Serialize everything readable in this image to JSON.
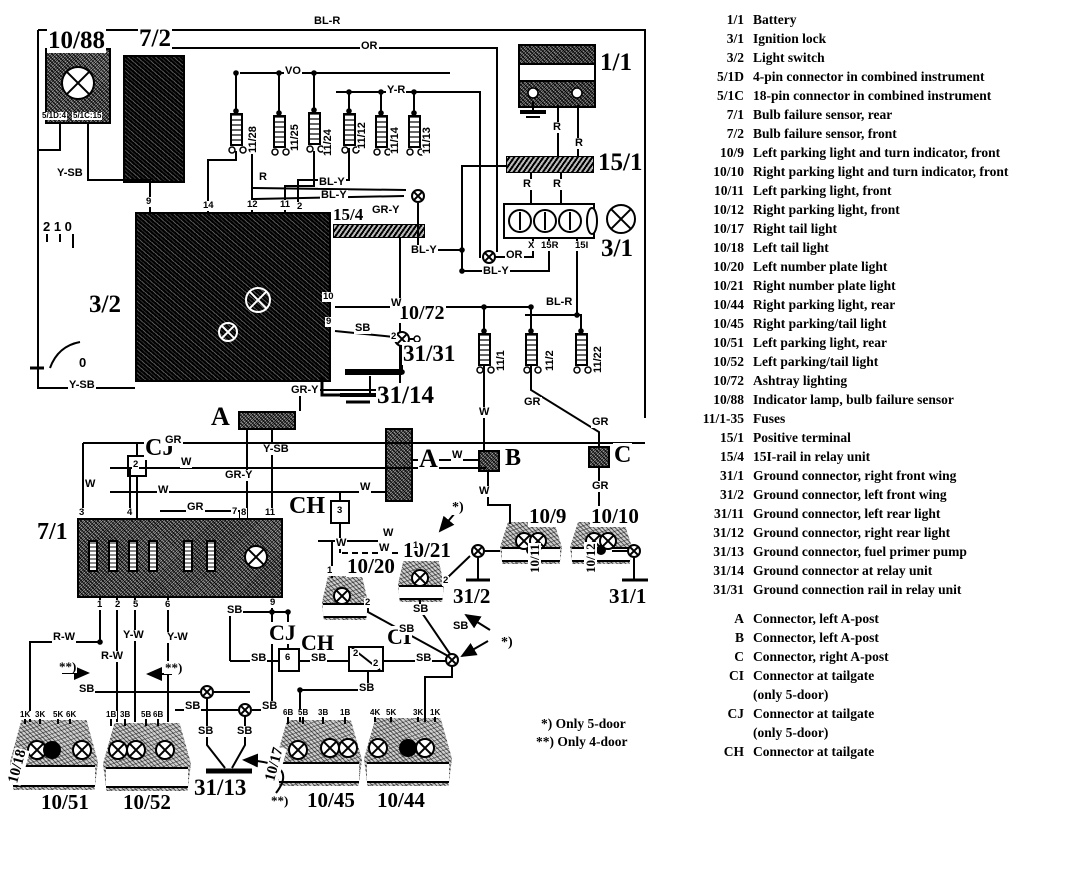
{
  "legend": {
    "entries": [
      {
        "code": "1/1",
        "desc": "Battery"
      },
      {
        "code": "3/1",
        "desc": "Ignition lock"
      },
      {
        "code": "3/2",
        "desc": "Light switch"
      },
      {
        "code": "5/1D",
        "desc": "4-pin connector in combined instrument"
      },
      {
        "code": "5/1C",
        "desc": "18-pin connector in combined instrument"
      },
      {
        "code": "7/1",
        "desc": "Bulb failure sensor, rear"
      },
      {
        "code": "7/2",
        "desc": "Bulb failure sensor, front"
      },
      {
        "code": "10/9",
        "desc": "Left parking light and turn indicator, front"
      },
      {
        "code": "10/10",
        "desc": "Right parking light and turn indicator, front"
      },
      {
        "code": "10/11",
        "desc": "Left parking light, front"
      },
      {
        "code": "10/12",
        "desc": "Right parking light, front"
      },
      {
        "code": "10/17",
        "desc": "Right tail light"
      },
      {
        "code": "10/18",
        "desc": "Left tail light"
      },
      {
        "code": "10/20",
        "desc": "Left number plate light"
      },
      {
        "code": "10/21",
        "desc": "Right number plate light"
      },
      {
        "code": "10/44",
        "desc": "Right parking light, rear"
      },
      {
        "code": "10/45",
        "desc": "Right parking/tail light"
      },
      {
        "code": "10/51",
        "desc": "Left parking light, rear"
      },
      {
        "code": "10/52",
        "desc": "Left parking/tail light"
      },
      {
        "code": "10/72",
        "desc": "Ashtray lighting"
      },
      {
        "code": "10/88",
        "desc": "Indicator lamp, bulb failure sensor"
      },
      {
        "code": "11/1-35",
        "desc": "Fuses"
      },
      {
        "code": "15/1",
        "desc": "Positive terminal"
      },
      {
        "code": "15/4",
        "desc": "15I-rail in relay unit"
      },
      {
        "code": "31/1",
        "desc": "Ground connector, right front wing"
      },
      {
        "code": "31/2",
        "desc": "Ground connector, left front wing"
      },
      {
        "code": "31/11",
        "desc": "Ground connector, left rear light"
      },
      {
        "code": "31/12",
        "desc": "Ground connector, right rear light"
      },
      {
        "code": "31/13",
        "desc": "Ground connector, fuel primer pump"
      },
      {
        "code": "31/14",
        "desc": "Ground connector at relay unit"
      },
      {
        "code": "31/31",
        "desc": "Ground connection rail in relay unit"
      }
    ],
    "connectors": [
      {
        "code": "A",
        "desc": "Connector, left A-post"
      },
      {
        "code": "B",
        "desc": "Connector, left A-post"
      },
      {
        "code": "C",
        "desc": "Connector, right A-post"
      },
      {
        "code": "CI",
        "desc": "Connector at tailgate",
        "desc2": "(only 5-door)"
      },
      {
        "code": "CJ",
        "desc": "Connector at tailgate",
        "desc2": "(only 5-door)"
      },
      {
        "code": "CH",
        "desc": "Connector at tailgate"
      }
    ]
  },
  "notes": {
    "five_door": "*) Only 5-door",
    "four_door": "**) Only 4-door"
  },
  "diagram": {
    "labels": [
      {
        "t": "10/88",
        "x": 47,
        "y": 28,
        "fs": 25,
        "cls": "comp"
      },
      {
        "t": "7/2",
        "x": 138,
        "y": 26,
        "fs": 25,
        "cls": "comp"
      },
      {
        "t": "1/1",
        "x": 599,
        "y": 50,
        "fs": 25,
        "cls": "comp"
      },
      {
        "t": "15/1",
        "x": 597,
        "y": 150,
        "fs": 25,
        "cls": "comp"
      },
      {
        "t": "3/1",
        "x": 600,
        "y": 236,
        "fs": 25,
        "cls": "comp"
      },
      {
        "t": "3/2",
        "x": 88,
        "y": 292,
        "fs": 25,
        "cls": "comp"
      },
      {
        "t": "15/4",
        "x": 332,
        "y": 206,
        "fs": 17,
        "cls": "comp"
      },
      {
        "t": "10/72",
        "x": 398,
        "y": 303,
        "fs": 20,
        "cls": "comp"
      },
      {
        "t": "31/31",
        "x": 402,
        "y": 342,
        "fs": 23,
        "cls": "comp"
      },
      {
        "t": "31/14",
        "x": 376,
        "y": 383,
        "fs": 25,
        "cls": "comp"
      },
      {
        "t": "A",
        "x": 210,
        "y": 404,
        "fs": 26,
        "cls": "comp"
      },
      {
        "t": "A",
        "x": 418,
        "y": 446,
        "fs": 26,
        "cls": "comp"
      },
      {
        "t": "CJ",
        "x": 144,
        "y": 436,
        "fs": 24,
        "cls": "comp"
      },
      {
        "t": "CH",
        "x": 288,
        "y": 494,
        "fs": 24,
        "cls": "comp"
      },
      {
        "t": "B",
        "x": 504,
        "y": 446,
        "fs": 24,
        "cls": "comp"
      },
      {
        "t": "C",
        "x": 613,
        "y": 443,
        "fs": 24,
        "cls": "comp"
      },
      {
        "t": "7/1",
        "x": 36,
        "y": 520,
        "fs": 24,
        "cls": "comp"
      },
      {
        "t": "10/9",
        "x": 528,
        "y": 506,
        "fs": 21,
        "cls": "comp"
      },
      {
        "t": "10/10",
        "x": 590,
        "y": 506,
        "fs": 21,
        "cls": "comp"
      },
      {
        "t": "10/20",
        "x": 346,
        "y": 556,
        "fs": 21,
        "cls": "comp"
      },
      {
        "t": "10/21",
        "x": 402,
        "y": 540,
        "fs": 21,
        "cls": "comp"
      },
      {
        "t": "31/2",
        "x": 452,
        "y": 586,
        "fs": 21,
        "cls": "comp"
      },
      {
        "t": "31/1",
        "x": 608,
        "y": 586,
        "fs": 21,
        "cls": "comp"
      },
      {
        "t": "CJ",
        "x": 268,
        "y": 622,
        "fs": 22,
        "cls": "comp"
      },
      {
        "t": "CH",
        "x": 300,
        "y": 632,
        "fs": 22,
        "cls": "comp"
      },
      {
        "t": "CI",
        "x": 386,
        "y": 626,
        "fs": 22,
        "cls": "comp"
      },
      {
        "t": "10/51",
        "x": 40,
        "y": 792,
        "fs": 21,
        "cls": "comp"
      },
      {
        "t": "10/52",
        "x": 122,
        "y": 792,
        "fs": 21,
        "cls": "comp"
      },
      {
        "t": "31/13",
        "x": 193,
        "y": 776,
        "fs": 23,
        "cls": "comp"
      },
      {
        "t": "10/45",
        "x": 306,
        "y": 790,
        "fs": 21,
        "cls": "comp"
      },
      {
        "t": "10/44",
        "x": 376,
        "y": 790,
        "fs": 21,
        "cls": "comp"
      },
      {
        "t": "10/18",
        "x": 6,
        "y": 782,
        "fs": 15,
        "cls": "comp",
        "rot": -75
      },
      {
        "t": "10/17",
        "x": 263,
        "y": 780,
        "fs": 15,
        "cls": "comp",
        "rot": -75
      },
      {
        "t": "10/11",
        "x": 528,
        "y": 574,
        "fs": 13,
        "cls": "comp",
        "rot": -90
      },
      {
        "t": "10/12",
        "x": 584,
        "y": 574,
        "fs": 13,
        "cls": "comp",
        "rot": -90
      },
      {
        "t": "*)",
        "x": 451,
        "y": 501,
        "fs": 14,
        "cls": "comp"
      },
      {
        "t": "*)",
        "x": 500,
        "y": 636,
        "fs": 14,
        "cls": "comp"
      },
      {
        "t": "**)",
        "x": 58,
        "y": 660,
        "fs": 13,
        "cls": "comp"
      },
      {
        "t": "**)",
        "x": 164,
        "y": 661,
        "fs": 13,
        "cls": "comp"
      },
      {
        "t": "**)",
        "x": 270,
        "y": 794,
        "fs": 13,
        "cls": "comp"
      },
      {
        "t": "5/1D:4",
        "x": 41,
        "y": 112,
        "cls": "small"
      },
      {
        "t": "5/1C:15",
        "x": 72,
        "y": 112,
        "cls": "small"
      },
      {
        "t": "BL-R",
        "x": 313,
        "y": 16,
        "cls": "wire"
      },
      {
        "t": "OR",
        "x": 360,
        "y": 41,
        "cls": "wire"
      },
      {
        "t": "VO",
        "x": 284,
        "y": 66,
        "cls": "wire"
      },
      {
        "t": "Y-R",
        "x": 386,
        "y": 85,
        "cls": "wire"
      },
      {
        "t": "R",
        "x": 258,
        "y": 172,
        "cls": "wire"
      },
      {
        "t": "BL-Y",
        "x": 318,
        "y": 177,
        "cls": "wire"
      },
      {
        "t": "BL-Y",
        "x": 320,
        "y": 190,
        "cls": "wire"
      },
      {
        "t": "R",
        "x": 552,
        "y": 122,
        "cls": "wire"
      },
      {
        "t": "R",
        "x": 574,
        "y": 138,
        "cls": "wire"
      },
      {
        "t": "R",
        "x": 522,
        "y": 179,
        "cls": "wire"
      },
      {
        "t": "R",
        "x": 552,
        "y": 179,
        "cls": "wire"
      },
      {
        "t": "X",
        "x": 527,
        "y": 241,
        "cls": "pin"
      },
      {
        "t": "15R",
        "x": 540,
        "y": 241,
        "cls": "pin"
      },
      {
        "t": "15I",
        "x": 574,
        "y": 241,
        "cls": "pin"
      },
      {
        "t": "OR",
        "x": 505,
        "y": 250,
        "cls": "wire"
      },
      {
        "t": "BL-Y",
        "x": 482,
        "y": 266,
        "cls": "wire"
      },
      {
        "t": "BL-R",
        "x": 545,
        "y": 297,
        "cls": "wire"
      },
      {
        "t": "BL-Y",
        "x": 410,
        "y": 245,
        "cls": "wire"
      },
      {
        "t": "GR-Y",
        "x": 371,
        "y": 205,
        "cls": "wire"
      },
      {
        "t": "2 1 0",
        "x": 42,
        "y": 220,
        "fs": 13,
        "cls": "wire"
      },
      {
        "t": "0",
        "x": 78,
        "y": 356,
        "fs": 13,
        "cls": "wire"
      },
      {
        "t": "Y-SB",
        "x": 56,
        "y": 168,
        "cls": "wire"
      },
      {
        "t": "9",
        "x": 145,
        "y": 197,
        "cls": "pin"
      },
      {
        "t": "14",
        "x": 202,
        "y": 201,
        "cls": "pin"
      },
      {
        "t": "12",
        "x": 246,
        "y": 200,
        "cls": "pin"
      },
      {
        "t": "11",
        "x": 279,
        "y": 200,
        "cls": "pin"
      },
      {
        "t": "2",
        "x": 296,
        "y": 202,
        "cls": "pin"
      },
      {
        "t": "10",
        "x": 322,
        "y": 292,
        "cls": "pin"
      },
      {
        "t": "9",
        "x": 325,
        "y": 317,
        "cls": "pin"
      },
      {
        "t": "W",
        "x": 390,
        "y": 298,
        "cls": "wire"
      },
      {
        "t": "SB",
        "x": 354,
        "y": 323,
        "cls": "wire"
      },
      {
        "t": "2",
        "x": 390,
        "y": 332,
        "cls": "pin"
      },
      {
        "t": "Y-SB",
        "x": 68,
        "y": 380,
        "cls": "wire"
      },
      {
        "t": "GR-Y",
        "x": 290,
        "y": 385,
        "cls": "wire"
      },
      {
        "t": "11/28",
        "x": 248,
        "y": 154,
        "cls": "wire",
        "rot": -90
      },
      {
        "t": "11/25",
        "x": 290,
        "y": 152,
        "cls": "wire",
        "rot": -90
      },
      {
        "t": "11/24",
        "x": 323,
        "y": 157,
        "cls": "wire",
        "rot": -90
      },
      {
        "t": "11/12",
        "x": 357,
        "y": 150,
        "cls": "wire",
        "rot": -90
      },
      {
        "t": "11/14",
        "x": 390,
        "y": 155,
        "cls": "wire",
        "rot": -90
      },
      {
        "t": "11/13",
        "x": 422,
        "y": 155,
        "cls": "wire",
        "rot": -90
      },
      {
        "t": "11/1",
        "x": 496,
        "y": 372,
        "cls": "wire",
        "rot": -90
      },
      {
        "t": "11/2",
        "x": 545,
        "y": 372,
        "cls": "wire",
        "rot": -90
      },
      {
        "t": "11/22",
        "x": 593,
        "y": 374,
        "cls": "wire",
        "rot": -90
      },
      {
        "t": "W",
        "x": 478,
        "y": 407,
        "cls": "wire"
      },
      {
        "t": "GR",
        "x": 523,
        "y": 397,
        "cls": "wire"
      },
      {
        "t": "GR",
        "x": 591,
        "y": 417,
        "cls": "wire"
      },
      {
        "t": "W",
        "x": 451,
        "y": 450,
        "cls": "wire"
      },
      {
        "t": "W",
        "x": 478,
        "y": 486,
        "cls": "wire"
      },
      {
        "t": "GR",
        "x": 591,
        "y": 481,
        "cls": "wire"
      },
      {
        "t": "Y-SB",
        "x": 262,
        "y": 444,
        "cls": "wire"
      },
      {
        "t": "GR-Y",
        "x": 224,
        "y": 470,
        "cls": "wire"
      },
      {
        "t": "GR",
        "x": 164,
        "y": 435,
        "cls": "wire"
      },
      {
        "t": "W",
        "x": 84,
        "y": 479,
        "cls": "wire"
      },
      {
        "t": "W",
        "x": 180,
        "y": 457,
        "cls": "wire"
      },
      {
        "t": "W",
        "x": 157,
        "y": 485,
        "cls": "wire"
      },
      {
        "t": "GR",
        "x": 186,
        "y": 502,
        "cls": "wire"
      },
      {
        "t": "W",
        "x": 359,
        "y": 482,
        "cls": "wire"
      },
      {
        "t": "3",
        "x": 78,
        "y": 508,
        "cls": "pin"
      },
      {
        "t": "4",
        "x": 126,
        "y": 508,
        "cls": "pin"
      },
      {
        "t": "7",
        "x": 231,
        "y": 507,
        "cls": "pin"
      },
      {
        "t": "8",
        "x": 240,
        "y": 508,
        "cls": "pin"
      },
      {
        "t": "11",
        "x": 264,
        "y": 508,
        "cls": "pin"
      },
      {
        "t": "1",
        "x": 96,
        "y": 600,
        "cls": "pin"
      },
      {
        "t": "2",
        "x": 114,
        "y": 600,
        "cls": "pin"
      },
      {
        "t": "5",
        "x": 132,
        "y": 600,
        "cls": "pin"
      },
      {
        "t": "6",
        "x": 164,
        "y": 600,
        "cls": "pin"
      },
      {
        "t": "9",
        "x": 269,
        "y": 598,
        "cls": "pin"
      },
      {
        "t": "SB",
        "x": 226,
        "y": 605,
        "cls": "wire"
      },
      {
        "t": "2",
        "x": 132,
        "y": 460,
        "cls": "pin"
      },
      {
        "t": "3",
        "x": 336,
        "y": 506,
        "cls": "pin"
      },
      {
        "t": "6",
        "x": 284,
        "y": 653,
        "cls": "pin"
      },
      {
        "t": "2",
        "x": 352,
        "y": 649,
        "cls": "pin"
      },
      {
        "t": "2",
        "x": 372,
        "y": 659,
        "cls": "pin"
      },
      {
        "t": "1",
        "x": 326,
        "y": 566,
        "cls": "pin"
      },
      {
        "t": "2",
        "x": 364,
        "y": 598,
        "cls": "pin"
      },
      {
        "t": "1",
        "x": 412,
        "y": 541,
        "cls": "pin"
      },
      {
        "t": "2",
        "x": 442,
        "y": 576,
        "cls": "pin"
      },
      {
        "t": "W",
        "x": 335,
        "y": 538,
        "cls": "wire"
      },
      {
        "t": "W",
        "x": 378,
        "y": 543,
        "cls": "wire"
      },
      {
        "t": "W",
        "x": 382,
        "y": 528,
        "cls": "wire"
      },
      {
        "t": "SB",
        "x": 412,
        "y": 604,
        "cls": "wire"
      },
      {
        "t": "SB",
        "x": 398,
        "y": 624,
        "cls": "wire"
      },
      {
        "t": "SB",
        "x": 452,
        "y": 621,
        "cls": "wire"
      },
      {
        "t": "SB",
        "x": 250,
        "y": 653,
        "cls": "wire"
      },
      {
        "t": "SB",
        "x": 310,
        "y": 653,
        "cls": "wire"
      },
      {
        "t": "SB",
        "x": 415,
        "y": 653,
        "cls": "wire"
      },
      {
        "t": "SB",
        "x": 358,
        "y": 683,
        "cls": "wire"
      },
      {
        "t": "R-W",
        "x": 52,
        "y": 632,
        "cls": "wire"
      },
      {
        "t": "R-W",
        "x": 100,
        "y": 651,
        "cls": "wire"
      },
      {
        "t": "Y-W",
        "x": 122,
        "y": 630,
        "cls": "wire"
      },
      {
        "t": "Y-W",
        "x": 166,
        "y": 632,
        "cls": "wire"
      },
      {
        "t": "SB",
        "x": 78,
        "y": 684,
        "cls": "wire"
      },
      {
        "t": "SB",
        "x": 184,
        "y": 701,
        "cls": "wire"
      },
      {
        "t": "SB",
        "x": 261,
        "y": 701,
        "cls": "wire"
      },
      {
        "t": "SB",
        "x": 197,
        "y": 726,
        "cls": "wire"
      },
      {
        "t": "SB",
        "x": 236,
        "y": 726,
        "cls": "wire"
      },
      {
        "t": "1K",
        "x": 19,
        "y": 711,
        "cls": "small"
      },
      {
        "t": "3K",
        "x": 34,
        "y": 711,
        "cls": "small"
      },
      {
        "t": "5K",
        "x": 52,
        "y": 711,
        "cls": "small"
      },
      {
        "t": "6K",
        "x": 65,
        "y": 711,
        "cls": "small"
      },
      {
        "t": "1B",
        "x": 105,
        "y": 711,
        "cls": "small"
      },
      {
        "t": "3B",
        "x": 119,
        "y": 711,
        "cls": "small"
      },
      {
        "t": "5B",
        "x": 140,
        "y": 711,
        "cls": "small"
      },
      {
        "t": "6B",
        "x": 152,
        "y": 711,
        "cls": "small"
      },
      {
        "t": "6B",
        "x": 282,
        "y": 709,
        "cls": "small"
      },
      {
        "t": "5B",
        "x": 297,
        "y": 709,
        "cls": "small"
      },
      {
        "t": "3B",
        "x": 317,
        "y": 709,
        "cls": "small"
      },
      {
        "t": "1B",
        "x": 339,
        "y": 709,
        "cls": "small"
      },
      {
        "t": "4K",
        "x": 369,
        "y": 709,
        "cls": "small"
      },
      {
        "t": "5K",
        "x": 385,
        "y": 709,
        "cls": "small"
      },
      {
        "t": "3K",
        "x": 412,
        "y": 709,
        "cls": "small"
      },
      {
        "t": "1K",
        "x": 429,
        "y": 709,
        "cls": "small"
      }
    ]
  }
}
